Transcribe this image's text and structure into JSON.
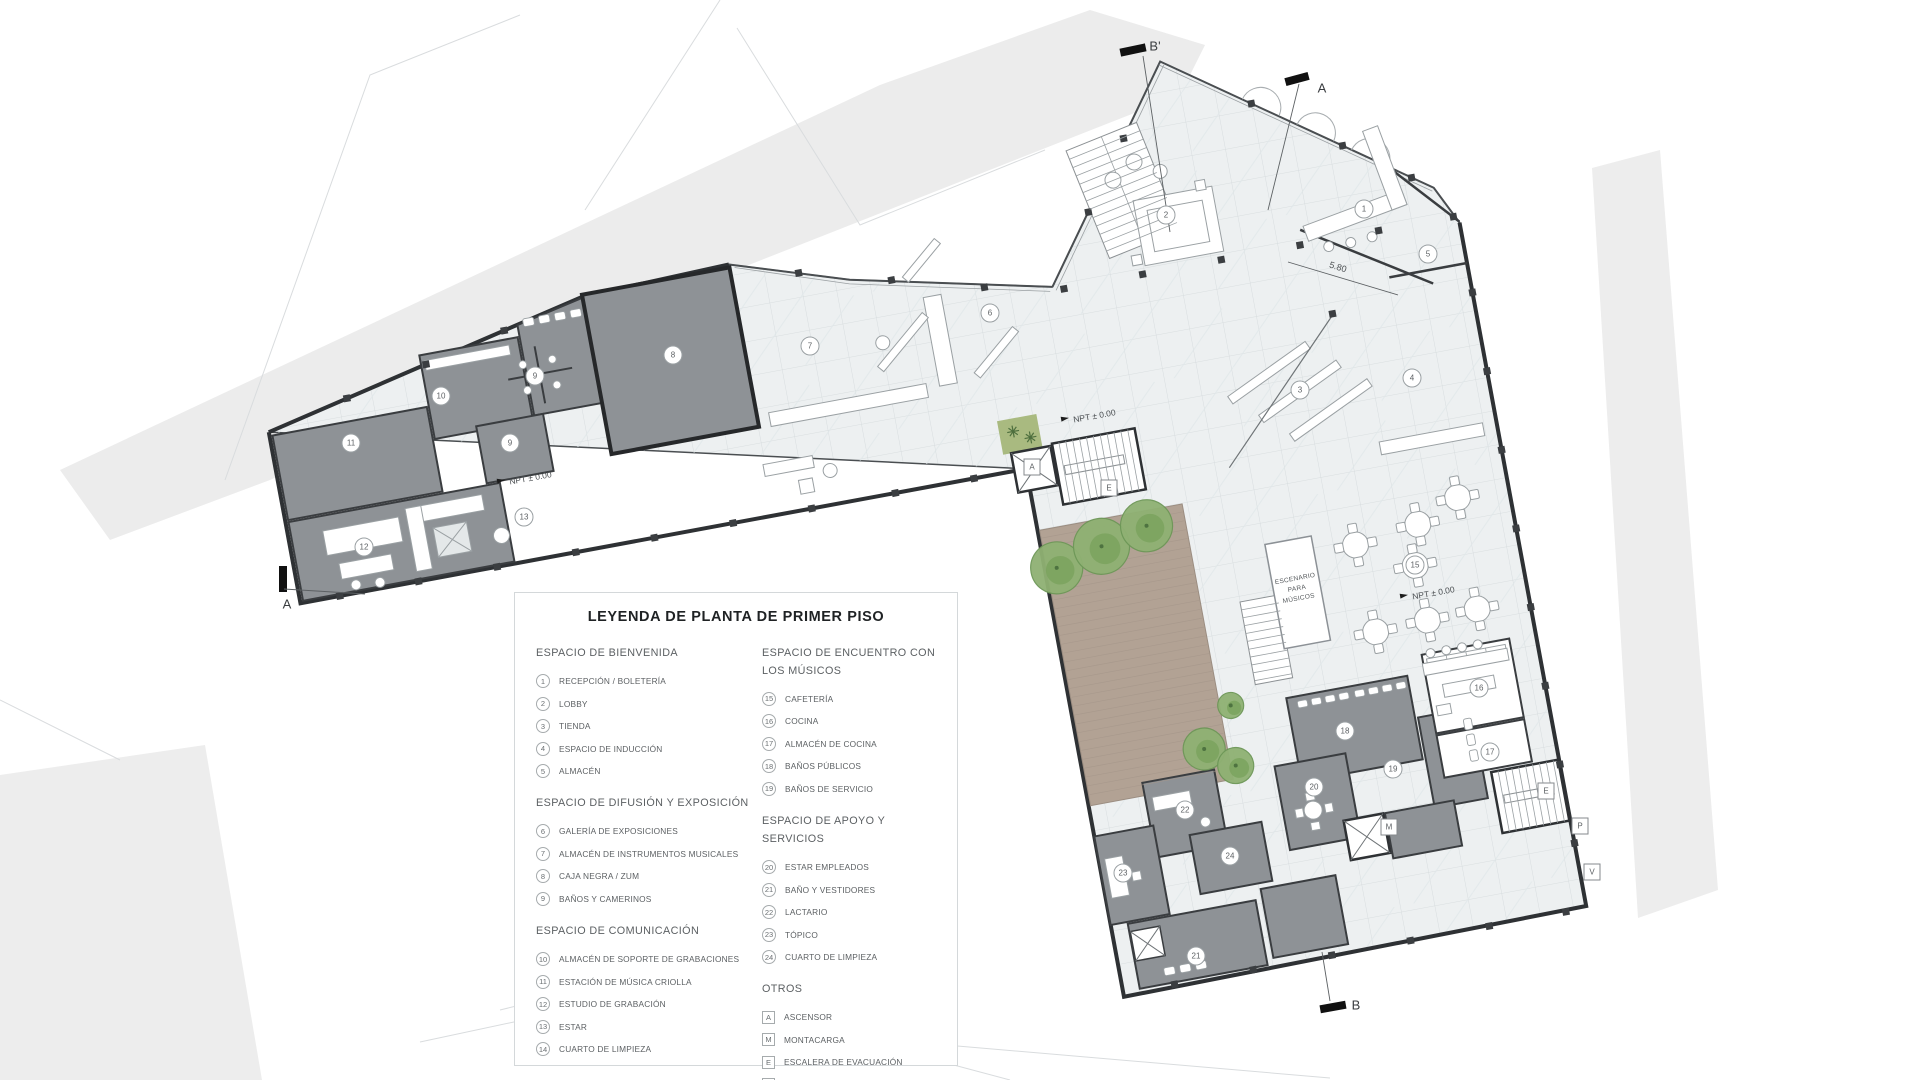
{
  "legend": {
    "title": "LEYENDA DE PLANTA DE PRIMER PISO",
    "sections": [
      {
        "title": "ESPACIO DE BIENVENIDA",
        "badge": "circle",
        "column": 1,
        "items": [
          {
            "k": "1",
            "label": "RECEPCIÓN / BOLETERÍA"
          },
          {
            "k": "2",
            "label": "LOBBY"
          },
          {
            "k": "3",
            "label": "TIENDA"
          },
          {
            "k": "4",
            "label": "ESPACIO DE INDUCCIÓN"
          },
          {
            "k": "5",
            "label": "ALMACÉN"
          }
        ]
      },
      {
        "title": "ESPACIO DE DIFUSIÓN Y EXPOSICIÓN",
        "badge": "circle",
        "column": 1,
        "items": [
          {
            "k": "6",
            "label": "GALERÍA DE EXPOSICIONES"
          },
          {
            "k": "7",
            "label": "ALMACÉN DE INSTRUMENTOS MUSICALES"
          },
          {
            "k": "8",
            "label": "CAJA NEGRA / ZUM"
          },
          {
            "k": "9",
            "label": "BAÑOS Y CAMERINOS"
          }
        ]
      },
      {
        "title": "ESPACIO DE COMUNICACIÓN",
        "badge": "circle",
        "column": 1,
        "items": [
          {
            "k": "10",
            "label": "ALMACÉN DE SOPORTE DE GRABACIONES"
          },
          {
            "k": "11",
            "label": "ESTACIÓN DE MÚSICA CRIOLLA"
          },
          {
            "k": "12",
            "label": "ESTUDIO DE GRABACIÓN"
          },
          {
            "k": "13",
            "label": "ESTAR"
          },
          {
            "k": "14",
            "label": "CUARTO DE LIMPIEZA"
          }
        ]
      },
      {
        "title": "ESPACIO DE ENCUENTRO CON LOS MÚSICOS",
        "badge": "circle",
        "column": 2,
        "items": [
          {
            "k": "15",
            "label": "CAFETERÍA"
          },
          {
            "k": "16",
            "label": "COCINA"
          },
          {
            "k": "17",
            "label": "ALMACÉN DE COCINA"
          },
          {
            "k": "18",
            "label": "BAÑOS PÚBLICOS"
          },
          {
            "k": "19",
            "label": "BAÑOS DE SERVICIO"
          }
        ]
      },
      {
        "title": "ESPACIO DE APOYO Y SERVICIOS",
        "badge": "circle",
        "column": 2,
        "items": [
          {
            "k": "20",
            "label": "ESTAR EMPLEADOS"
          },
          {
            "k": "21",
            "label": "BAÑO Y VESTIDORES"
          },
          {
            "k": "22",
            "label": "LACTARIO"
          },
          {
            "k": "23",
            "label": "TÓPICO"
          },
          {
            "k": "24",
            "label": "CUARTO DE LIMPIEZA"
          }
        ]
      },
      {
        "title": "OTROS",
        "badge": "square",
        "column": 2,
        "items": [
          {
            "k": "A",
            "label": "ASCENSOR"
          },
          {
            "k": "M",
            "label": "MONTACARGA"
          },
          {
            "k": "E",
            "label": "ESCALERA DE EVACUACIÓN"
          },
          {
            "k": "V",
            "label": "INGRESO VEHICULAR"
          },
          {
            "k": "P",
            "label": "INGRESO PEATONAL"
          }
        ]
      }
    ]
  },
  "plan": {
    "markers": [
      {
        "t": "c",
        "label": "1",
        "x": 1364,
        "y": 209
      },
      {
        "t": "c",
        "label": "2",
        "x": 1166,
        "y": 215
      },
      {
        "t": "c",
        "label": "3",
        "x": 1300,
        "y": 390
      },
      {
        "t": "c",
        "label": "4",
        "x": 1412,
        "y": 378
      },
      {
        "t": "c",
        "label": "5",
        "x": 1428,
        "y": 254
      },
      {
        "t": "c",
        "label": "6",
        "x": 990,
        "y": 313
      },
      {
        "t": "c",
        "label": "7",
        "x": 810,
        "y": 346
      },
      {
        "t": "c",
        "label": "8",
        "x": 673,
        "y": 355
      },
      {
        "t": "c",
        "label": "9",
        "x": 535,
        "y": 376
      },
      {
        "t": "c",
        "label": "9",
        "x": 510,
        "y": 443
      },
      {
        "t": "c",
        "label": "10",
        "x": 441,
        "y": 396
      },
      {
        "t": "c",
        "label": "11",
        "x": 351,
        "y": 443
      },
      {
        "t": "c",
        "label": "12",
        "x": 364,
        "y": 547
      },
      {
        "t": "c",
        "label": "13",
        "x": 524,
        "y": 517
      },
      {
        "t": "c",
        "label": "15",
        "x": 1415,
        "y": 565
      },
      {
        "t": "c",
        "label": "16",
        "x": 1479,
        "y": 688
      },
      {
        "t": "c",
        "label": "17",
        "x": 1490,
        "y": 752
      },
      {
        "t": "c",
        "label": "18",
        "x": 1345,
        "y": 731
      },
      {
        "t": "c",
        "label": "19",
        "x": 1393,
        "y": 769
      },
      {
        "t": "c",
        "label": "20",
        "x": 1314,
        "y": 787
      },
      {
        "t": "c",
        "label": "21",
        "x": 1196,
        "y": 956
      },
      {
        "t": "c",
        "label": "22",
        "x": 1185,
        "y": 810
      },
      {
        "t": "c",
        "label": "23",
        "x": 1123,
        "y": 873
      },
      {
        "t": "c",
        "label": "24",
        "x": 1230,
        "y": 856
      },
      {
        "t": "s",
        "label": "A",
        "x": 1032,
        "y": 467
      },
      {
        "t": "s",
        "label": "E",
        "x": 1109,
        "y": 488
      },
      {
        "t": "s",
        "label": "E",
        "x": 1546,
        "y": 791
      },
      {
        "t": "s",
        "label": "M",
        "x": 1389,
        "y": 827
      },
      {
        "t": "s",
        "label": "P",
        "x": 1580,
        "y": 826
      },
      {
        "t": "s",
        "label": "V",
        "x": 1592,
        "y": 872
      },
      {
        "t": "sec",
        "label": "B'",
        "x": 1155,
        "y": 46
      },
      {
        "t": "sec",
        "label": "A",
        "x": 1322,
        "y": 88
      },
      {
        "t": "sec",
        "label": "A",
        "x": 287,
        "y": 604
      },
      {
        "t": "sec",
        "label": "B",
        "x": 1356,
        "y": 1005
      },
      {
        "t": "npt",
        "label": "NPT ± 0.00",
        "x": 524,
        "y": 479,
        "rot": -10
      },
      {
        "t": "npt",
        "label": "NPT ± 0.00",
        "x": 1088,
        "y": 417,
        "rot": -10
      },
      {
        "t": "npt",
        "label": "NPT ± 0.00",
        "x": 1427,
        "y": 594,
        "rot": -10
      },
      {
        "t": "dim",
        "label": "5.80",
        "x": 1338,
        "y": 267,
        "rot": 17
      },
      {
        "t": "stage",
        "label": "ESCENARIO\nPARA\nMÚSICOS",
        "x": 1297,
        "y": 589,
        "rot": -10.5
      }
    ]
  },
  "colors": {
    "room_fill": "#8e9296",
    "room_wall": "#3a3d40",
    "floor": "#edf0f1",
    "floor_grid": "#d3d9db",
    "deck": "#b2a294",
    "tree": "#8fb173",
    "street": "#ececec",
    "heavy_wall": "#2e3134"
  }
}
